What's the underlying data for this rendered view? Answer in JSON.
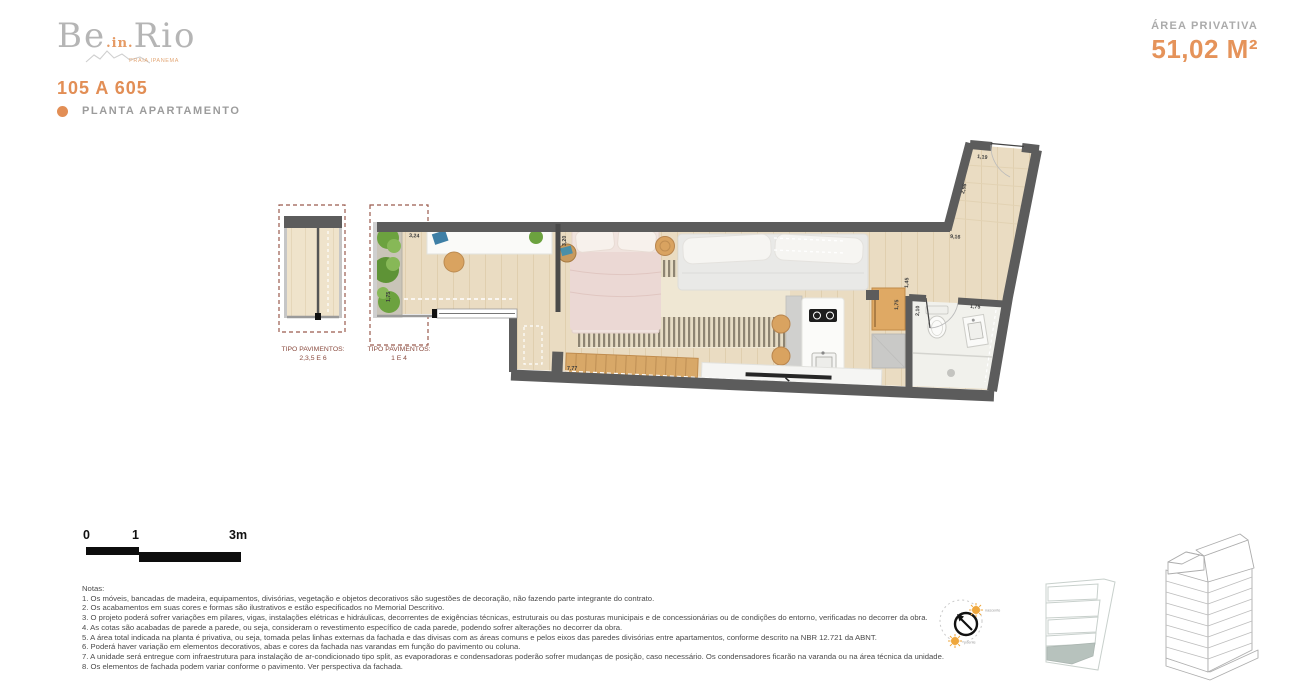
{
  "header": {
    "logo_part1": "Be",
    "logo_part2": ".in.",
    "logo_part3": "Rio",
    "logo_tagline": "PRAIA IPANEMA",
    "unit_code": "105 A 605",
    "plan_type_label": "PLANTA APARTAMENTO",
    "area_label": "ÁREA PRIVATIVA",
    "area_value": "51,02 M²"
  },
  "floor_variants": [
    {
      "line1": "TIPO PAVIMENTOS:",
      "line2": "2,3,5 E 6"
    },
    {
      "line1": "TIPO PAVIMENTOS:",
      "line2": "1 E 4"
    }
  ],
  "dimensions": {
    "balcony_width": "3,24",
    "balcony_depth": "1,75",
    "sliding_door": "3,20",
    "living_length": "7,77",
    "kitchen_wall": "1,45",
    "cabinet": "1,75",
    "bathroom_width": "2,10",
    "bathroom_sink_wall": "1,75",
    "total_depth": "9,16",
    "hall_wall": "2,98",
    "entry_door": "1,19"
  },
  "scale_bar": {
    "tick0": "0",
    "tick1": "1",
    "tick3": "3m"
  },
  "orientation": {
    "sunrise_label": "nascente",
    "sunset_label": "poente"
  },
  "notes": {
    "title": "Notas:",
    "items": [
      "1. Os móveis, bancadas de madeira, equipamentos, divisórias, vegetação e objetos decorativos são sugestões de decoração, não fazendo parte integrante do contrato.",
      "2. Os acabamentos em suas cores e formas são ilustrativos e estão especificados no Memorial Descritivo.",
      "3. O projeto poderá sofrer variações em pilares, vigas, instalações elétricas e hidráulicas, decorrentes de exigências técnicas, estruturais ou das posturas municipais e de concessionárias ou de condições do entorno, verificadas no decorrer da obra.",
      "4. As cotas são acabadas de parede a parede, ou seja, consideram o revestimento específico de cada parede, podendo sofrer alterações no decorrer da obra.",
      "5. A área total indicada na planta é privativa, ou seja, tomada pelas linhas externas da fachada e das divisas com as áreas comuns e pelos eixos das paredes divisórias entre apartamentos, conforme descrito na NBR 12.721 da ABNT.",
      "6. Poderá haver variação em elementos decorativos, abas e cores da fachada nas varandas em função do pavimento ou coluna.",
      "7. A unidade será entregue com infraestrutura para instalação de ar-condicionado tipo split, as evaporadoras e condensadoras poderão sofrer mudanças de posição, caso necessário. Os condensadores ficarão na varanda ou na área técnica da unidade.",
      "8. Os elementos de fachada podem variar conforme o pavimento. Ver perspectiva da fachada."
    ]
  },
  "colors": {
    "accent_orange": "#E28E55",
    "label_gray": "#9C9C9C",
    "variant_label_maroon": "#8A4B3F",
    "wall_gray": "#5C5C5C",
    "floor_wood": "#EADCC2"
  }
}
